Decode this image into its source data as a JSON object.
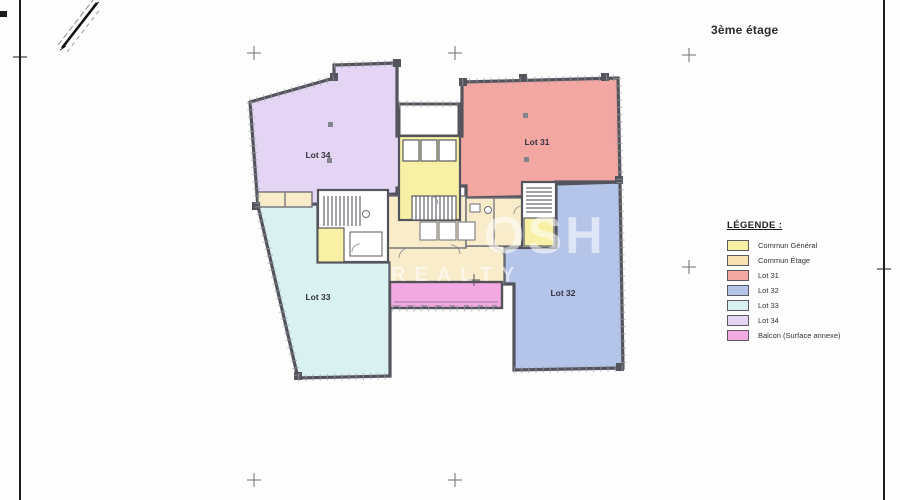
{
  "sheet": {
    "title": "3ème étage"
  },
  "legend": {
    "title": "LÉGENDE :",
    "items": [
      {
        "label": "Commun Général",
        "color": "#f6f0a2",
        "style": "background:#f6f0a2"
      },
      {
        "label": "Commun Étage",
        "color": "#f8e2b4",
        "style": "background:#f8e2b4"
      },
      {
        "label": "Lot 31",
        "color": "#f3a7a3",
        "style": "background:#f3a7a3"
      },
      {
        "label": "Lot 32",
        "color": "#b5c5ea",
        "style": "background:#b5c5ea"
      },
      {
        "label": "Lot 33",
        "color": "#d9f2f1",
        "style": "background:#d9f2f1"
      },
      {
        "label": "Lot 34",
        "color": "#e3d5f3",
        "style": "background:#e3d5f3"
      },
      {
        "label": "Balcon (Surface annexe)",
        "color": "#f3a9e2",
        "style": "background:#f3a9e2"
      }
    ]
  },
  "plan": {
    "wall_color": "#54545c",
    "lots": {
      "lot34": {
        "label": "Lot 34",
        "color": "#e3d5f3"
      },
      "lot31": {
        "label": "Lot 31",
        "color": "#f3a7a3"
      },
      "lot33": {
        "label": "Lot 33",
        "color": "#d9f2f1"
      },
      "lot32": {
        "label": "Lot 32",
        "color": "#b5c5ea"
      }
    },
    "commun_general_color": "#f7f0a5",
    "commun_etage_color": "#f8ecca",
    "balcon_color": "#f3a9e2"
  },
  "watermark": {
    "line1": "OSH",
    "line2": "REALTY"
  }
}
